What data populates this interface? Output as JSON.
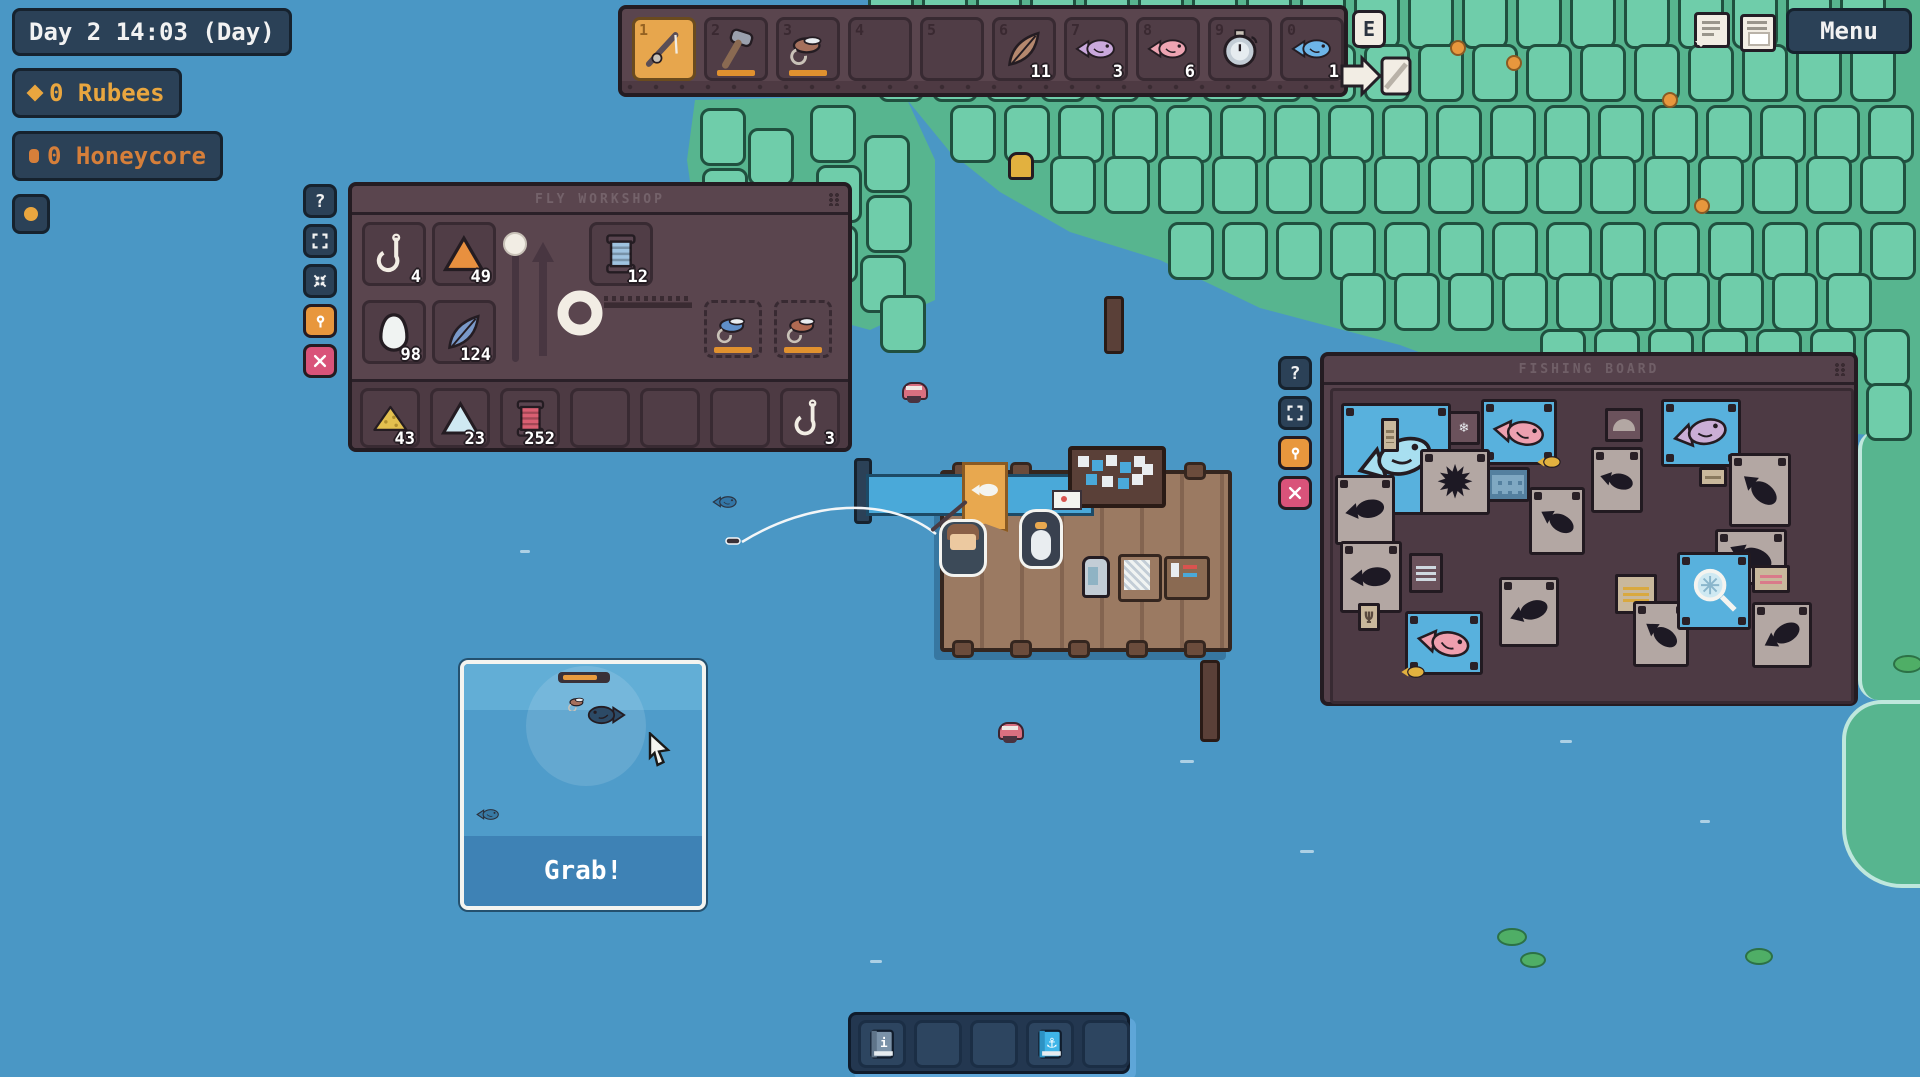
{
  "hud": {
    "clock": "Day 2 14:03 (Day)",
    "rubees": "0 Rubees",
    "honeycore": "0 Honeycore",
    "accents": {
      "gold": "#e9a63f",
      "orange": "#d67f3a"
    }
  },
  "hotbar": {
    "slots": [
      {
        "key": "1",
        "item": "rod",
        "selected": true
      },
      {
        "key": "2",
        "item": "hammer",
        "underline": true
      },
      {
        "key": "3",
        "item": "fly",
        "color": "#a5705c",
        "underline": true
      },
      {
        "key": "4"
      },
      {
        "key": "5"
      },
      {
        "key": "6",
        "item": "feather",
        "color": "#b5886e",
        "count": "11"
      },
      {
        "key": "7",
        "item": "fish",
        "color": "#c9a8dc",
        "count": "3"
      },
      {
        "key": "8",
        "item": "fish",
        "color": "#eda4b2",
        "count": "6"
      },
      {
        "key": "9",
        "item": "stopwatch"
      },
      {
        "key": "0",
        "item": "fish",
        "color": "#6db5e8",
        "count": "1"
      }
    ]
  },
  "hints": {
    "interact_key": "E"
  },
  "top_right": {
    "menu_label": "Menu"
  },
  "workshop": {
    "title": "FLY WORKSHOP",
    "upper_slots": [
      {
        "item": "hook",
        "count": "4"
      },
      {
        "item": "cone",
        "color": "#e8903f",
        "count": "49"
      },
      {
        "item": "egg",
        "count": "98"
      },
      {
        "item": "feather",
        "color": "#7a99c9",
        "count": "124"
      },
      {
        "item": "spool",
        "color": "#9fc3e0",
        "count": "12"
      }
    ],
    "fly_slots": [
      {
        "item": "fly",
        "color": "#5f8fc9"
      },
      {
        "item": "fly",
        "color": "#b06a52"
      }
    ],
    "bottom_slots": [
      {
        "item": "powder",
        "color": "#e3c04f",
        "count": "43"
      },
      {
        "item": "cone",
        "color": "#cfe9f2",
        "count": "23"
      },
      {
        "item": "spool",
        "color": "#d95f72",
        "count": "252"
      },
      {},
      {},
      {},
      {
        "item": "hook",
        "count": "3"
      }
    ],
    "side_buttons": [
      {
        "glyph": "help",
        "label": "?",
        "bg": "#2b4157"
      },
      {
        "glyph": "resize",
        "bg": "#2b4157"
      },
      {
        "glyph": "collapse",
        "bg": "#2b4157"
      },
      {
        "glyph": "pin",
        "bg": "#e8973d"
      },
      {
        "glyph": "close",
        "bg": "#d9537a"
      }
    ]
  },
  "board": {
    "title": "FISHING BOARD",
    "side_buttons": [
      {
        "glyph": "help",
        "label": "?",
        "bg": "#2b4157"
      },
      {
        "glyph": "resize",
        "bg": "#2b4157"
      },
      {
        "glyph": "pin",
        "bg": "#e8973d"
      },
      {
        "glyph": "close",
        "bg": "#d9537a"
      }
    ],
    "cards": [
      {
        "x": 8,
        "y": 12,
        "w": 110,
        "h": 112,
        "kind": "fish",
        "color": "#a8dff0",
        "rot": -18
      },
      {
        "x": 48,
        "y": 27,
        "w": 18,
        "h": 34,
        "kind": "note"
      },
      {
        "x": 115,
        "y": 20,
        "w": 32,
        "h": 34,
        "kind": "note-snow"
      },
      {
        "x": 148,
        "y": 8,
        "w": 76,
        "h": 66,
        "kind": "fish",
        "color": "#eda0b0",
        "rot": 8,
        "gold": "br"
      },
      {
        "x": 153,
        "y": 76,
        "w": 44,
        "h": 35,
        "kind": "calendar"
      },
      {
        "x": 87,
        "y": 58,
        "w": 70,
        "h": 66,
        "kind": "sil-sun"
      },
      {
        "x": 2,
        "y": 84,
        "w": 60,
        "h": 70,
        "kind": "sil",
        "rot": -10
      },
      {
        "x": 196,
        "y": 96,
        "w": 56,
        "h": 68,
        "kind": "sil",
        "rot": 30
      },
      {
        "x": 272,
        "y": 17,
        "w": 38,
        "h": 34,
        "kind": "note-arch"
      },
      {
        "x": 258,
        "y": 56,
        "w": 52,
        "h": 66,
        "kind": "sil",
        "rot": 15
      },
      {
        "x": 328,
        "y": 8,
        "w": 80,
        "h": 68,
        "kind": "fish",
        "color": "#cbaed6",
        "rot": -12
      },
      {
        "x": 366,
        "y": 76,
        "w": 28,
        "h": 20,
        "kind": "note"
      },
      {
        "x": 396,
        "y": 62,
        "w": 62,
        "h": 74,
        "kind": "sil",
        "rot": 40
      },
      {
        "x": 382,
        "y": 138,
        "w": 72,
        "h": 56,
        "kind": "sil",
        "rot": 25
      },
      {
        "x": 7,
        "y": 150,
        "w": 62,
        "h": 72,
        "kind": "sil",
        "rot": -5
      },
      {
        "x": 76,
        "y": 162,
        "w": 34,
        "h": 40,
        "kind": "note-grid"
      },
      {
        "x": 25,
        "y": 212,
        "w": 22,
        "h": 28,
        "kind": "note-trident"
      },
      {
        "x": 72,
        "y": 220,
        "w": 78,
        "h": 64,
        "kind": "fish",
        "color": "#ef9fae",
        "rot": 10,
        "gold": "bl"
      },
      {
        "x": 166,
        "y": 186,
        "w": 60,
        "h": 70,
        "kind": "sil",
        "rot": -20
      },
      {
        "x": 282,
        "y": 183,
        "w": 42,
        "h": 40,
        "kind": "note-gold"
      },
      {
        "x": 300,
        "y": 210,
        "w": 56,
        "h": 66,
        "kind": "sil",
        "rot": 35
      },
      {
        "x": 344,
        "y": 161,
        "w": 74,
        "h": 78,
        "kind": "net"
      },
      {
        "x": 419,
        "y": 174,
        "w": 38,
        "h": 28,
        "kind": "note-pink"
      },
      {
        "x": 419,
        "y": 211,
        "w": 60,
        "h": 66,
        "kind": "sil",
        "rot": -30
      }
    ]
  },
  "grab_popup": {
    "label": "Grab!"
  },
  "toolbar": {
    "slots": [
      {
        "item": "book-info"
      },
      {},
      {},
      {
        "item": "book-fish"
      },
      {}
    ]
  }
}
